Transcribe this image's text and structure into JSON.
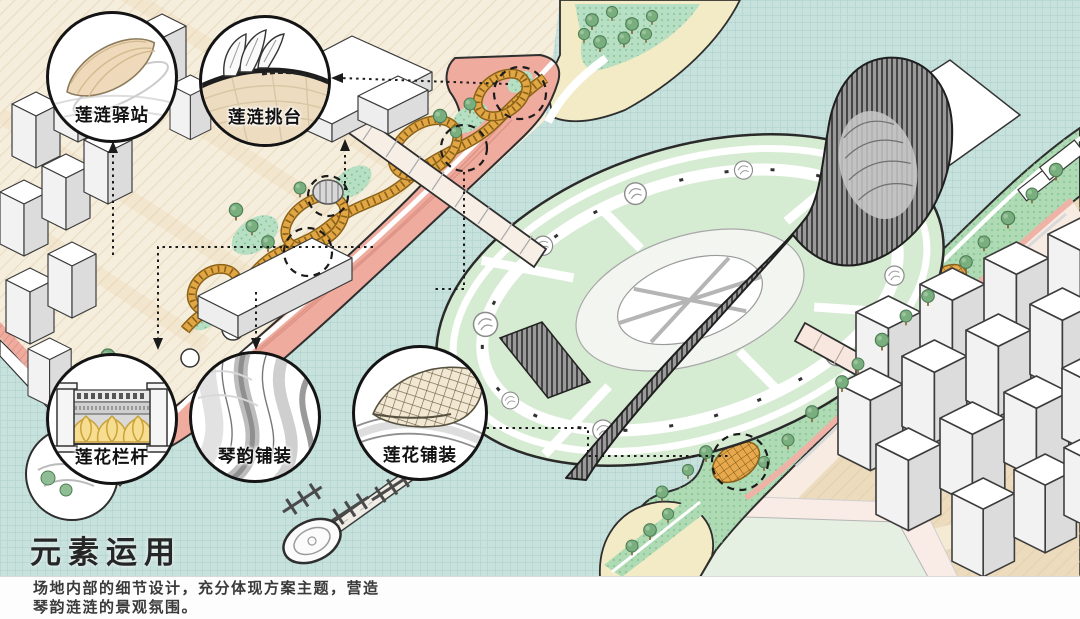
{
  "legend": {
    "title": "元素运用",
    "description_lines": [
      "场地内部的细节设计，充分体现方案主题，营造",
      "琴韵涟涟的景观氛围。"
    ]
  },
  "callouts": [
    {
      "id": "lianlian-station",
      "label": "莲涟驿站"
    },
    {
      "id": "lianlian-cantilever-deck",
      "label": "莲涟挑台"
    },
    {
      "id": "lotus-railing",
      "label": "莲花栏杆"
    },
    {
      "id": "qin-rhythm-paving",
      "label": "琴韵铺装"
    },
    {
      "id": "lotus-paving",
      "label": "莲花铺装"
    }
  ],
  "colors": {
    "water": "#c7e1dd",
    "water_grid": "#adcfc9",
    "land": "#f6eedd",
    "land_hatch": "#dcc9a6",
    "sand": "#f3ebc6",
    "promenade_pink": "#efab9e",
    "ribbon_orange": "#e2a645",
    "lawn_green": "#b7dfc3",
    "riverside_green": "#aedbb4",
    "island_green": "#d6ecd2",
    "tree_green": "#79ae7e",
    "structure_dark": "#8c8c8c",
    "outline": "#2e2e2e",
    "bridge_cream": "#f7efe6"
  }
}
